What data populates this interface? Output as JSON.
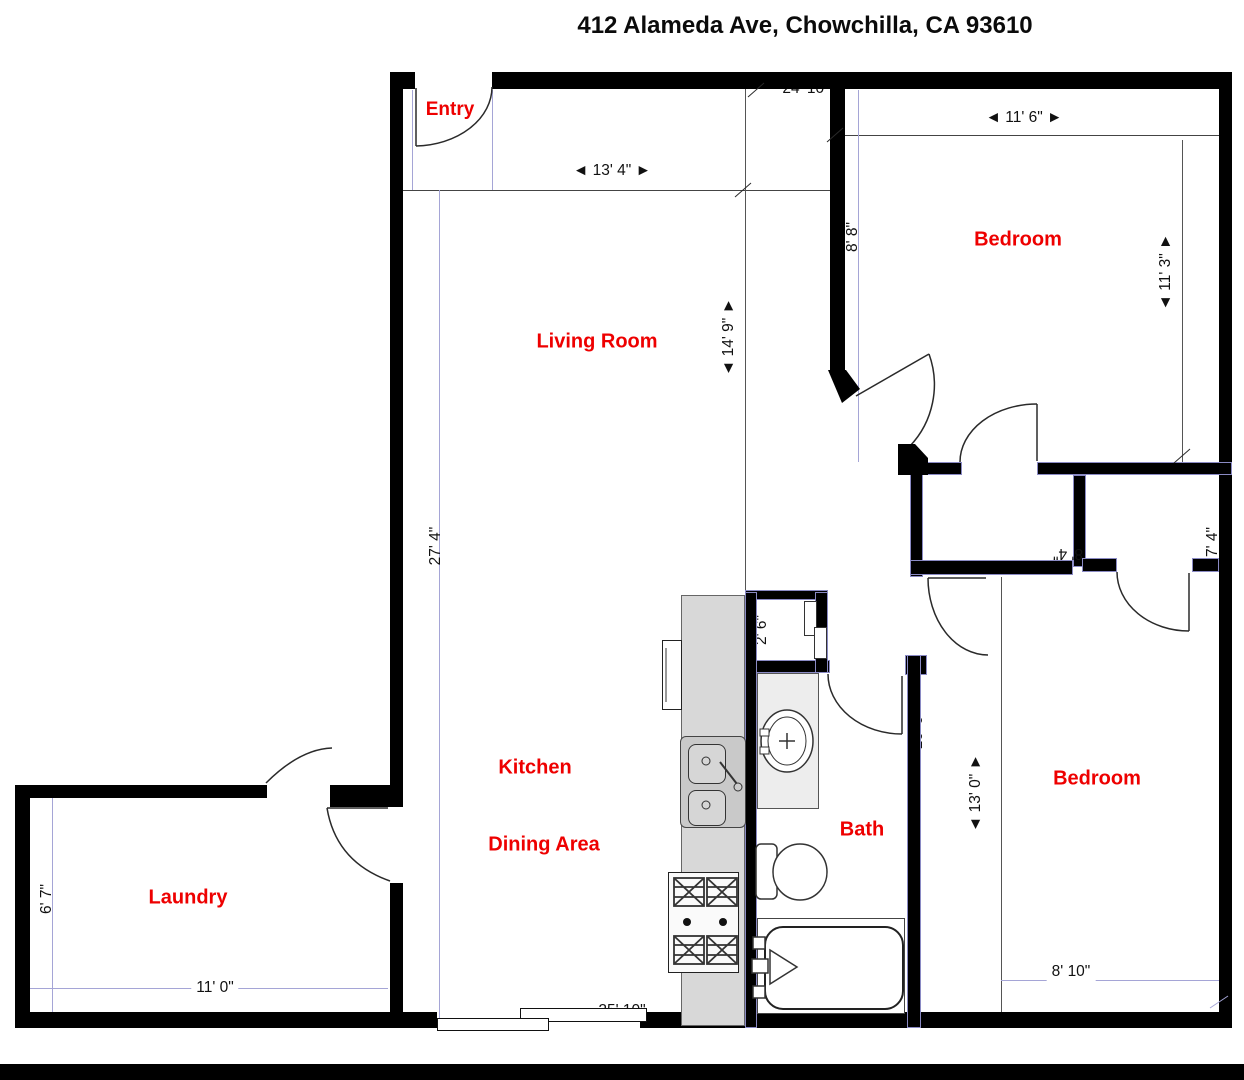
{
  "title": "412 Alameda Ave, Chowchilla, CA 93610",
  "rooms": {
    "entry": "Entry",
    "living_room": "Living Room",
    "bedroom_top": "Bedroom",
    "bedroom_bottom": "Bedroom",
    "kitchen": "Kitchen",
    "dining": "Dining Area",
    "bath": "Bath",
    "laundry": "Laundry"
  },
  "dimensions": {
    "top_overall": "24' 10\"",
    "entry_width": "◄ 13' 4\" ►",
    "bedroom_top_width": "◄ 11' 6\" ►",
    "bedroom_top_wall": "8' 8\"",
    "bedroom_top_depth": "◄ 11' 3\" ►",
    "living_depth": "◄ 14' 9\" ►",
    "left_overall": "27' 4\"",
    "hall_closet_width": "8' 4\"",
    "closet_depth": "2' 1\"",
    "closet_right_width": "7' 4\"",
    "small_closet": "2' 6\"",
    "bath_depth": "10' 6\"",
    "bedroom_bottom_depth": "◄ 13' 0\" ►",
    "bedroom_bottom_width": "8' 10\"",
    "laundry_width": "11' 0\"",
    "laundry_depth": "6' 7\"",
    "bottom_overall": "25' 10\""
  },
  "colors": {
    "wall": "#000000",
    "label_red": "#ee0000",
    "dim_line_lavender": "#a5a5d6"
  }
}
